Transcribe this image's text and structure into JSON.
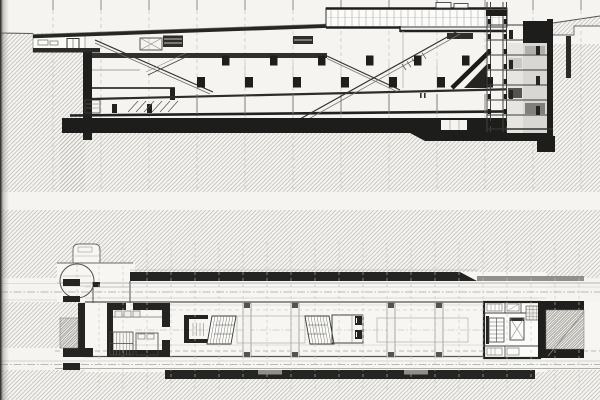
{
  "page": {
    "kind": "scanned architecture book page",
    "drawings": [
      {
        "id": "longitudinal-section",
        "label": "Longitudinal section: underground hall with sloped escalators, rooflight clerestory, service tower and ground poche",
        "position": "top"
      },
      {
        "id": "floor-plan",
        "label": "Underground floor plan: long station hall with escalator banks, end cores, circular street drum and flanking tunnel tubes",
        "position": "bottom"
      }
    ],
    "text_content": []
  },
  "palette": {
    "paper": "#f5f4f0",
    "drawing_white": "#fafaf7",
    "hatch_line": "#b3b1ac",
    "hatch_dense_line": "#908e89",
    "ink_black": "#1d1d1b",
    "ink_mid": "#55534f",
    "ink_light": "#a8a6a2",
    "grid_line": "#c2c0bc",
    "gray_fill": "#d8d7d3",
    "gutter_shadow": "#3f3d3a"
  }
}
